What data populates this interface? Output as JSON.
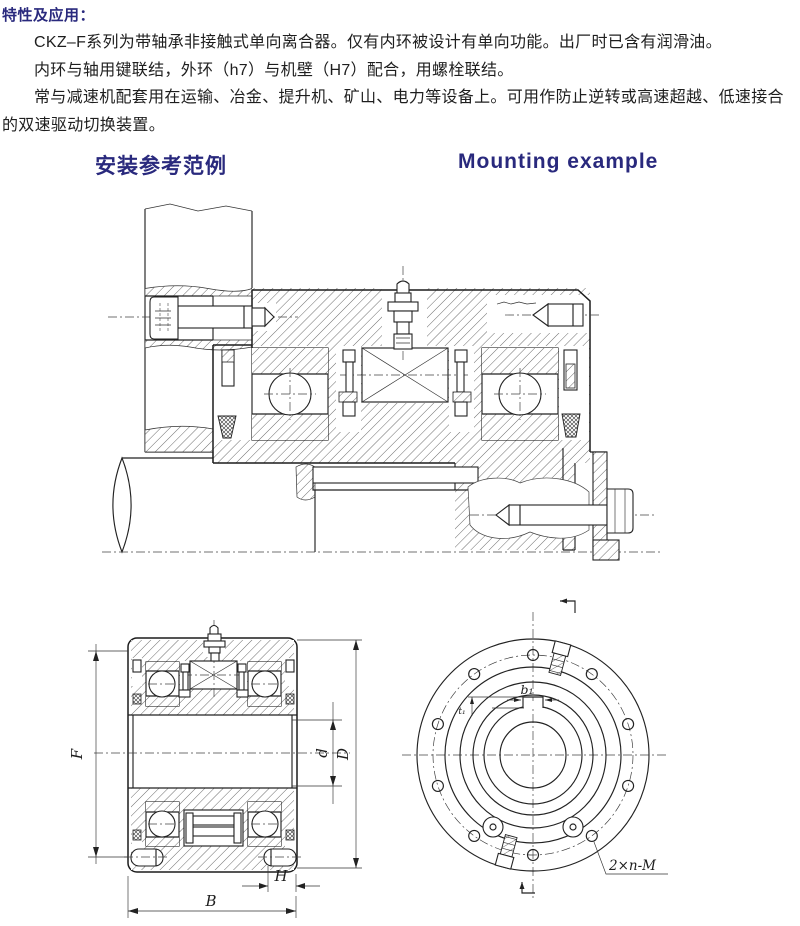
{
  "colors": {
    "heading": "#29297d",
    "body_text": "#1e1e1e",
    "line_art": "#222222"
  },
  "intro": {
    "heading": "特性及应用：",
    "para1": "CKZ–F系列为带轴承非接触式单向离合器。仅有内环被设计有单向功能。出厂时已含有润滑油。",
    "para2": "内环与轴用键联结，外环（h7）与机壁（H7）配合，用螺栓联结。",
    "para3": "常与减速机配套用在运输、冶金、提升机、矿山、电力等设备上。可用作防止逆转或高速超越、低速接合的双速驱动切换装置。"
  },
  "section": {
    "title_zh": "安装参考范例",
    "title_en": "Mounting example"
  },
  "side_view": {
    "labels": {
      "F": "F",
      "d": "d",
      "D": "D",
      "H": "H",
      "B": "B"
    }
  },
  "front_view": {
    "labels": {
      "keyway_width": "b₁",
      "keyway_depth": "t₁",
      "bolt_pattern": "2×n-M"
    }
  }
}
